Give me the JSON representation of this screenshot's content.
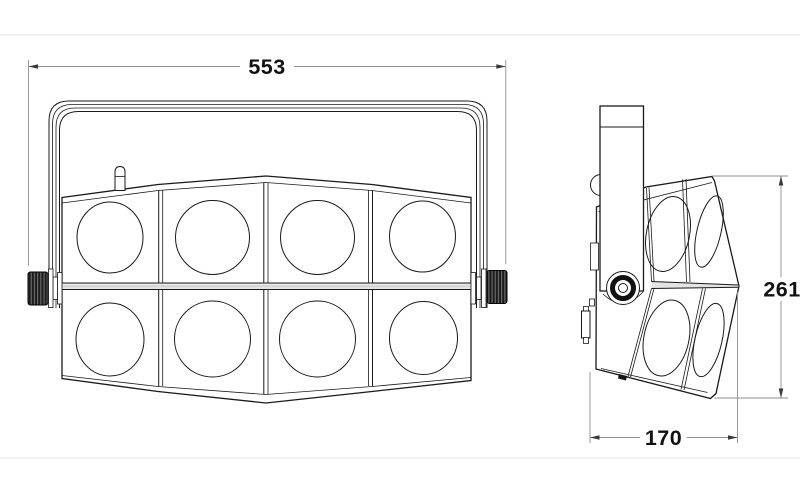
{
  "drawing": {
    "kind": "technical-dimension-drawing",
    "views": {
      "front": {
        "name": "front-view",
        "lens_rows": 2,
        "lens_columns": 4
      },
      "side": {
        "name": "side-view"
      }
    },
    "dimensions": [
      {
        "id": "width",
        "value": "553",
        "view": "front",
        "orientation": "horizontal"
      },
      {
        "id": "height",
        "value": "261",
        "view": "side",
        "orientation": "vertical"
      },
      {
        "id": "depth",
        "value": "170",
        "view": "side",
        "orientation": "horizontal"
      }
    ],
    "colors": {
      "line": "#1a1a1a",
      "dim": "#8f8f8f",
      "band": "#e4e4e4",
      "knob": "#1c1c1c",
      "rule": "#ececec",
      "background": "#ffffff"
    }
  }
}
